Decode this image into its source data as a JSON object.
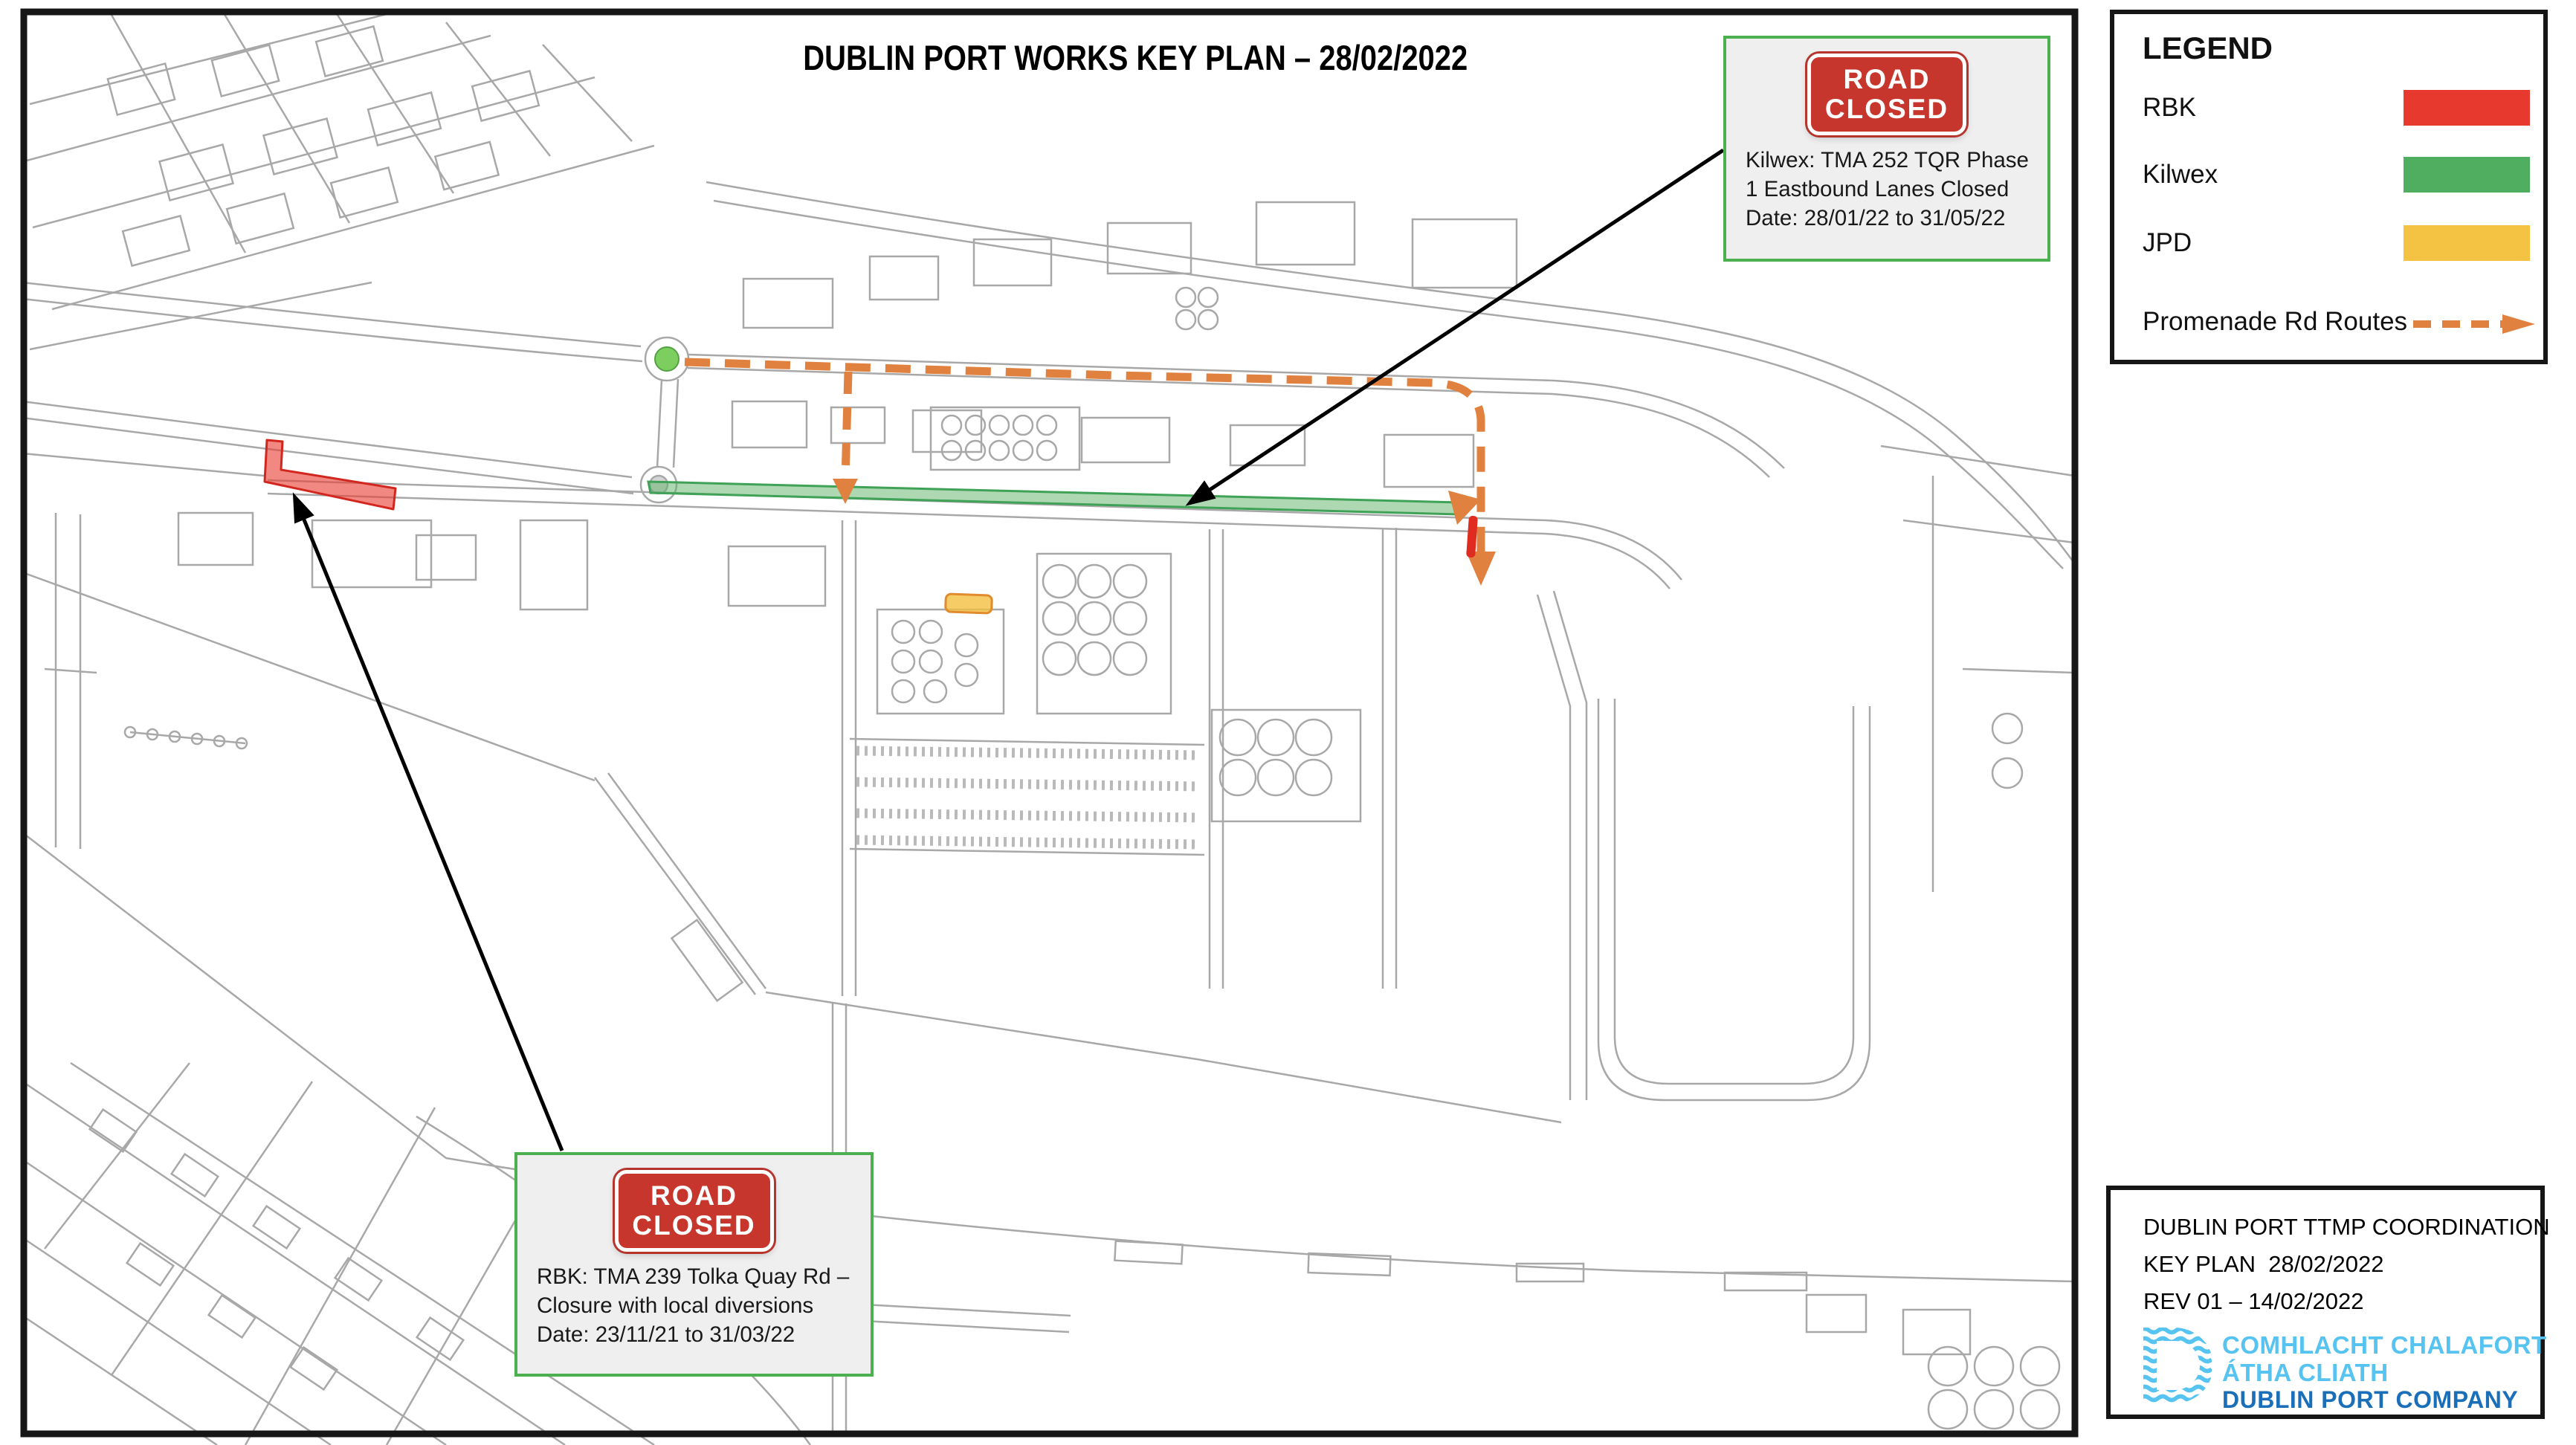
{
  "title": "DUBLIN PORT WORKS KEY PLAN – 28/02/2022",
  "legend": {
    "heading": "LEGEND",
    "items": [
      {
        "label": "RBK",
        "color": "#E8392E"
      },
      {
        "label": "Kilwex",
        "color": "#4FAE60"
      },
      {
        "label": "JPD",
        "color": "#F5C343"
      }
    ],
    "route_item": {
      "label": "Promenade Rd Routes",
      "color": "#E0813F"
    }
  },
  "callouts": {
    "kilwex": {
      "sign": [
        "ROAD",
        "CLOSED"
      ],
      "lines": [
        "Kilwex: TMA 252 TQR Phase",
        "1 Eastbound Lanes Closed",
        "Date: 28/01/22 to 31/05/22"
      ]
    },
    "rbk": {
      "sign": [
        "ROAD",
        "CLOSED"
      ],
      "lines": [
        "RBK: TMA 239 Tolka Quay Rd –",
        "Closure with local diversions",
        "Date: 23/11/21 to 31/03/22"
      ]
    }
  },
  "title_block": {
    "lines": [
      "DUBLIN PORT TTMP COORDINATION",
      "KEY PLAN  28/02/2022",
      "REV 01 – 14/02/2022"
    ],
    "logo": {
      "line1": "COMHLACHT CHALAFORT",
      "line2": "ÁTHA CLIATH",
      "line3": "DUBLIN PORT COMPANY",
      "light_blue": "#56C3F1",
      "dark_blue": "#1B6FB8"
    }
  },
  "colors": {
    "callout_border": "#4CAF50",
    "sign_red": "#C7362C",
    "map_line_gray": "#A8A8A8",
    "map_border": "#161616"
  },
  "map": {
    "overlays": [
      {
        "name": "rbk-closure-highlight",
        "color": "#E8392E"
      },
      {
        "name": "kilwex-closure-highlight",
        "color": "#4FAE60"
      },
      {
        "name": "jpd-works-highlight",
        "color": "#F5C343"
      },
      {
        "name": "promenade-rd-route",
        "color": "#E0813F"
      },
      {
        "name": "signal-roundabout-marker",
        "color": "#7CCF5F"
      }
    ]
  }
}
